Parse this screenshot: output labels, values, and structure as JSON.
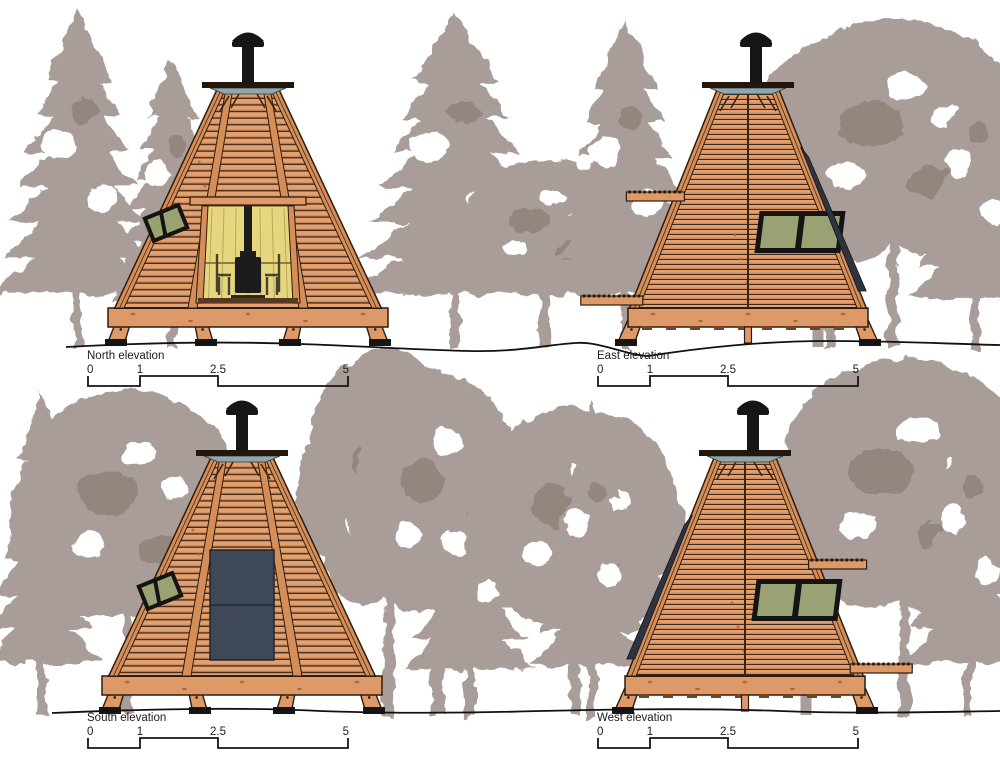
{
  "sheet": {
    "background": "#ffffff",
    "description": "Four architectural elevation drawings of a timber tipi cabin among tree silhouettes"
  },
  "palette": {
    "wood": "#e2a171",
    "wood2": "#dd9a68",
    "wood_rail": "#d68e58",
    "slat_gap": "#43281a",
    "outline": "#2e1d0e",
    "interior_wall": "#e6d77f",
    "interior_line": "#b9a75a",
    "stove": "#1c1c1c",
    "window_pane": "#9aa273",
    "window_frame": "#141414",
    "solar_panel": "#3e4857",
    "skylight": "#8fa7ad",
    "tree": "#a89d98",
    "tree_dark": "#93867f",
    "chimney": "#161616",
    "ground_line": "#111111",
    "label_text": "#1c1c1c"
  },
  "elevations": [
    {
      "id": "north",
      "label": "North elevation",
      "view": "front",
      "features": {
        "door_opening": true,
        "stove": true,
        "window": "upper-left",
        "solar_panel": false,
        "planks": null,
        "solar_edge": null,
        "chimney": true
      },
      "scale": {
        "unit_ticks": [
          "0",
          "1",
          "2.5",
          "5"
        ]
      }
    },
    {
      "id": "east",
      "label": "East elevation",
      "view": "side",
      "features": {
        "door_opening": false,
        "stove": false,
        "window": "right-of-seam",
        "solar_panel": false,
        "planks": "left",
        "solar_edge": "right",
        "chimney": true
      },
      "scale": {
        "unit_ticks": [
          "0",
          "1",
          "2.5",
          "5"
        ]
      }
    },
    {
      "id": "south",
      "label": "South elevation",
      "view": "front",
      "features": {
        "door_opening": false,
        "stove": false,
        "window": "upper-left",
        "solar_panel": true,
        "planks": null,
        "solar_edge": null,
        "chimney": true
      },
      "scale": {
        "unit_ticks": [
          "0",
          "1",
          "2.5",
          "5"
        ]
      }
    },
    {
      "id": "west",
      "label": "West elevation",
      "view": "side",
      "features": {
        "door_opening": false,
        "stove": false,
        "window": "right-of-seam",
        "solar_panel": false,
        "planks": "right",
        "solar_edge": "left",
        "chimney": true
      },
      "scale": {
        "unit_ticks": [
          "0",
          "1",
          "2.5",
          "5"
        ]
      }
    }
  ]
}
